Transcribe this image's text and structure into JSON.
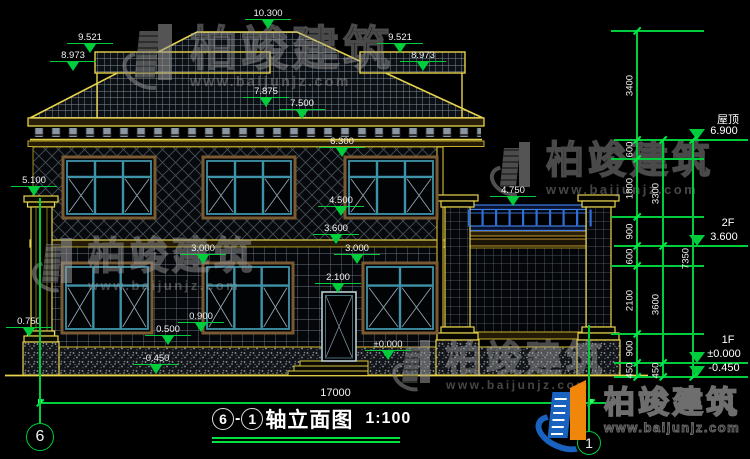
{
  "drawing": {
    "title": {
      "axis_from": "6",
      "separator": "-",
      "axis_to": "1",
      "name": "轴立面图",
      "scale": "1:100"
    },
    "bottom_axis_bubbles": [
      {
        "label": "6"
      },
      {
        "label": "1"
      }
    ],
    "elevation_markers": [
      {
        "value": "10.300",
        "ax": 268,
        "ay": 30
      },
      {
        "value": "9.521",
        "ax": 90,
        "ay": 54
      },
      {
        "value": "8.973",
        "ax": 73,
        "ay": 72
      },
      {
        "value": "9.521",
        "ax": 400,
        "ay": 54
      },
      {
        "value": "8.973",
        "ax": 423,
        "ay": 72
      },
      {
        "value": "7.875",
        "ax": 266,
        "ay": 108
      },
      {
        "value": "7.500",
        "ax": 302,
        "ay": 120
      },
      {
        "value": "6.300",
        "ax": 342,
        "ay": 158
      },
      {
        "value": "5.100",
        "ax": 34,
        "ay": 197
      },
      {
        "value": "4.750",
        "ax": 513,
        "ay": 207
      },
      {
        "value": "4.500",
        "ax": 341,
        "ay": 217
      },
      {
        "value": "3.600",
        "ax": 336,
        "ay": 245
      },
      {
        "value": "3.000",
        "ax": 203,
        "ay": 265
      },
      {
        "value": "3.000",
        "ax": 357,
        "ay": 265
      },
      {
        "value": "2.100",
        "ax": 338,
        "ay": 294
      },
      {
        "value": "0.900",
        "ax": 201,
        "ay": 333
      },
      {
        "value": "0.750",
        "ax": 29,
        "ay": 338
      },
      {
        "value": "0.500",
        "ax": 168,
        "ay": 346
      },
      {
        "value": "±0.000",
        "ax": 388,
        "ay": 361
      },
      {
        "value": "-0.450",
        "ax": 156,
        "ay": 375
      }
    ],
    "right_levels": [
      {
        "name": "屋顶",
        "value": "6.900",
        "y": 140
      },
      {
        "name": "2F",
        "value": "3.600",
        "y": 246
      },
      {
        "name": "1F",
        "value": "±0.000",
        "y": 363
      },
      {
        "name": "",
        "value": "-0.450",
        "y": 377
      }
    ],
    "leader_rows": [
      31,
      159,
      217,
      266,
      334
    ],
    "chains": [
      {
        "x": 637,
        "y1": 31,
        "y2": 377,
        "ticks": [
          31,
          140,
          159,
          217,
          246,
          266,
          334,
          363,
          377
        ],
        "labels": [
          {
            "t": "3400",
            "y": 85
          },
          {
            "t": "600",
            "y": 149
          },
          {
            "t": "1800",
            "y": 188
          },
          {
            "t": "900",
            "y": 231
          },
          {
            "t": "600",
            "y": 256
          },
          {
            "t": "2100",
            "y": 300
          },
          {
            "t": "900",
            "y": 348
          },
          {
            "t": "450",
            "y": 370
          }
        ]
      },
      {
        "x": 663,
        "y1": 140,
        "y2": 377,
        "ticks": [
          140,
          246,
          363,
          377
        ],
        "labels": [
          {
            "t": "3300",
            "y": 193
          },
          {
            "t": "3600",
            "y": 304
          },
          {
            "t": "450",
            "y": 370
          }
        ]
      },
      {
        "x": 693,
        "y1": 140,
        "y2": 377,
        "ticks": [
          140,
          377
        ],
        "labels": [
          {
            "t": "7350",
            "y": 258
          }
        ]
      }
    ],
    "bottom_dim": {
      "label": "17000",
      "x1": 38,
      "x2": 633,
      "y": 403,
      "tick_xs": [
        40,
        591
      ]
    },
    "watermark": {
      "brand": "柏竣建筑",
      "site": "www.baijunjz.com"
    },
    "logo": {
      "brand": "柏竣建筑",
      "site": "www.baijunjz.com"
    },
    "colors": {
      "dim_green": "#00cd3c",
      "cad_yellow": "#e8d44d",
      "rail_blue": "#2f6fd8",
      "frame_teal": "#3f93a8",
      "frame_brown": "#7a5a32"
    }
  }
}
